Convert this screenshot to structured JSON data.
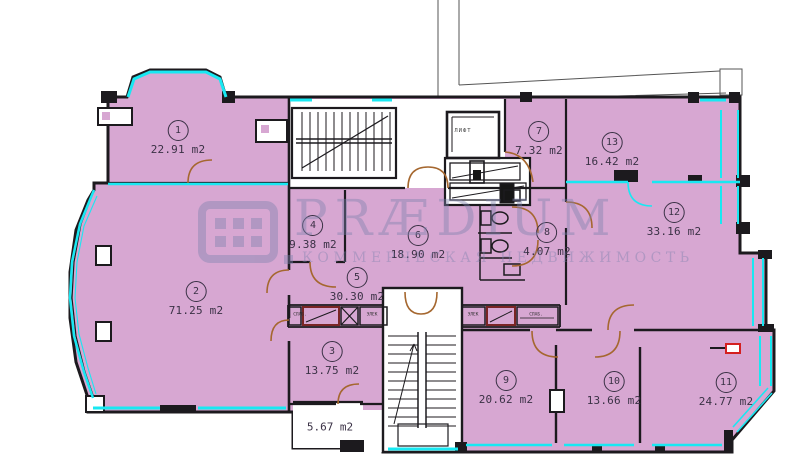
{
  "watermark": {
    "brand": "PRÆDIUM",
    "subtitle": "КОММЕРЧЕСКАЯ НЕДВИЖИМОСТЬ"
  },
  "elevator": {
    "label": "ЛИФТ"
  },
  "rooms": [
    {
      "number": "1",
      "area": "22.91 m2"
    },
    {
      "number": "2",
      "area": "71.25 m2"
    },
    {
      "number": "3",
      "area": "13.75 m2"
    },
    {
      "number": "4",
      "area": "9.38 m2"
    },
    {
      "number": "5",
      "area": "30.30 m2"
    },
    {
      "number": "6",
      "area": "18.90 m2"
    },
    {
      "number": "7",
      "area": "7.32 m2"
    },
    {
      "number": "8",
      "area": "4.07 m2"
    },
    {
      "number": "9",
      "area": "20.62 m2"
    },
    {
      "number": "10",
      "area": "13.66 m2"
    },
    {
      "number": "11",
      "area": "24.77 m2"
    },
    {
      "number": "12",
      "area": "33.16 m2"
    },
    {
      "number": "13",
      "area": "16.42 m2"
    }
  ],
  "unnumbered_room": {
    "area": "5.67 m2"
  },
  "utility": {
    "slab": "СЛАБ.",
    "elek": "ЭЛЕК"
  },
  "colors": {
    "room_fill": "#d7a7d2",
    "wall": "#1c1a1e",
    "window_highlight": "#18e8f2",
    "door": "#a5672f",
    "shaft_accent": "#7a2525",
    "alert_red": "#d42020",
    "watermark": "#7d82ae"
  }
}
